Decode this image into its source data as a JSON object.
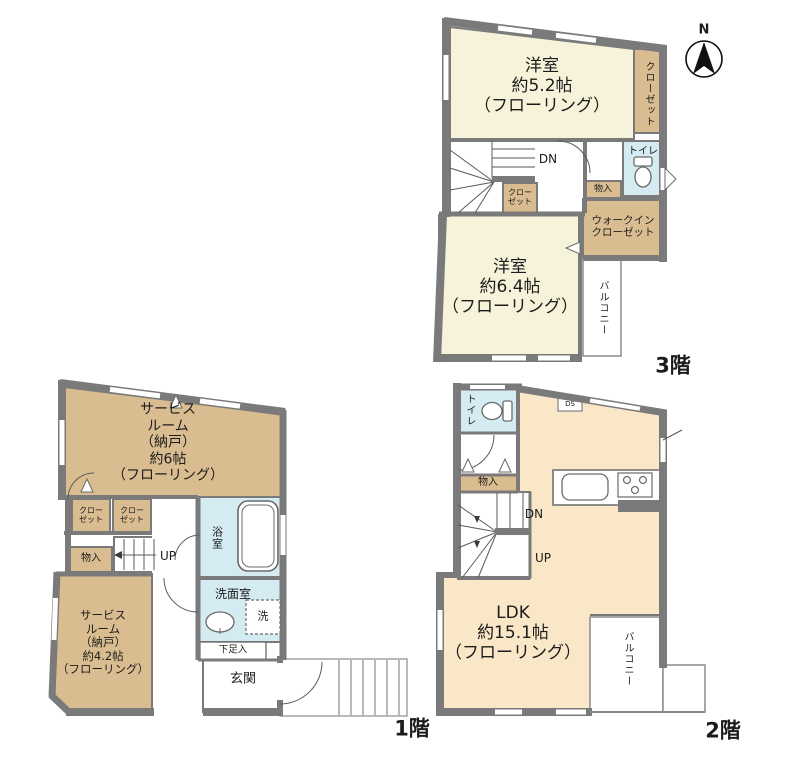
{
  "compass": {
    "north_label": "N"
  },
  "colors": {
    "wall_gray": "#7a7a7a",
    "room_cream": "#f7f3da",
    "room_peach": "#f9e7c8",
    "closet_tan": "#d9bd90",
    "wet_area_blue": "#d4ebf2",
    "white": "#ffffff"
  },
  "floor3": {
    "name_label": "3階",
    "rooms": {
      "bedroom52": "洋室\n約5.2帖\n（フローリング）",
      "closet_tall": "クローゼット",
      "stairs_dn": "DN",
      "closet_small": "クロー\nゼット",
      "storage": "物入",
      "toilet": "トイレ",
      "walkin_closet": "ウォークイン\nクローゼット",
      "bedroom64": "洋室\n約6.4帖\n（フローリング）",
      "balcony": "バルコニー"
    }
  },
  "floor1": {
    "name_label": "1階",
    "rooms": {
      "service_room6": "サービス\nルーム\n（納戸）\n約6帖\n（フローリング）",
      "closet_a": "クロー\nゼット",
      "closet_b": "クロー\nゼット",
      "storage": "物入",
      "stairs_up": "UP",
      "bathroom": "浴室",
      "washroom": "洗面室",
      "washer": "洗",
      "shoe_storage": "下足入",
      "entrance": "玄関",
      "service_room42": "サービス\nルーム\n（納戸）\n約4.2帖\n（フローリング）"
    }
  },
  "floor2": {
    "name_label": "2階",
    "rooms": {
      "toilet": "トイレ",
      "duct_space": "DS",
      "storage": "物入",
      "stairs_dn": "DN",
      "stairs_up": "UP",
      "ldk": "LDK\n約15.1帖\n（フローリング）",
      "balcony": "バルコニー"
    }
  }
}
